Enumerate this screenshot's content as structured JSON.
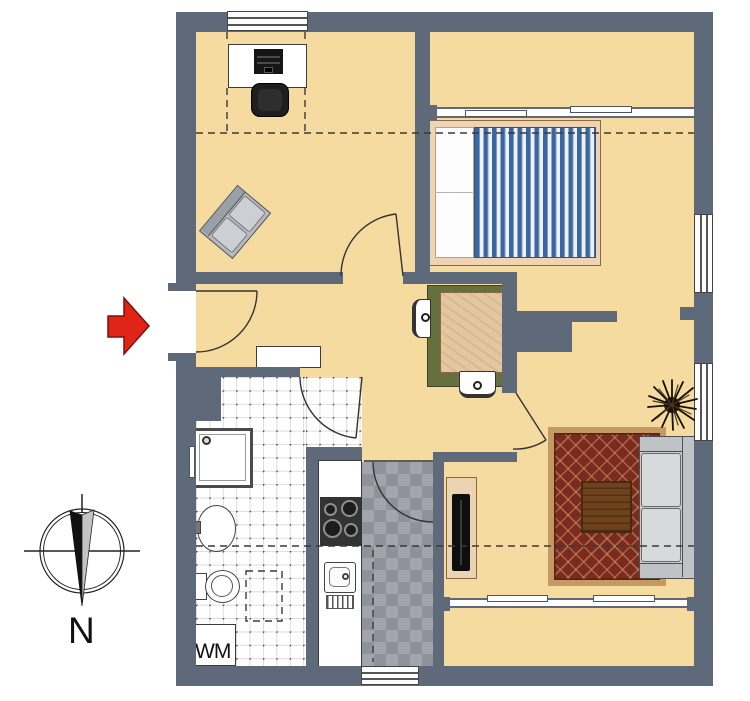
{
  "labels": {
    "washing_machine": "WM",
    "compass_north": "N"
  },
  "colors": {
    "wall": "#5e6a79",
    "floor_beige": "#f6dba0",
    "bathroom_tile": "#ffffff",
    "kitchen_tile_dark": "#8e929a",
    "kitchen_tile_light": "#a2a5ab",
    "bed_blanket_blue": "#3a67a0",
    "bed_frame_tan": "#eed4b5",
    "rug_border": "#c49a62",
    "rug_field": "#7b2a1f",
    "coffee_table_brown": "#6e431c",
    "dining_bench_green": "#666f3e",
    "dining_table_tan": "#e4c79f",
    "sofa_gray": "#c8cbce",
    "entrance_arrow_red": "#e02418"
  },
  "icons": {
    "entrance_arrow": "red-arrow-right",
    "compass": "compass-rose-needle-pointing-down",
    "plant": "potted-plant-top-view",
    "doors": "quarter-circle-door-swings",
    "section_lines": "dashed-section-lines"
  }
}
